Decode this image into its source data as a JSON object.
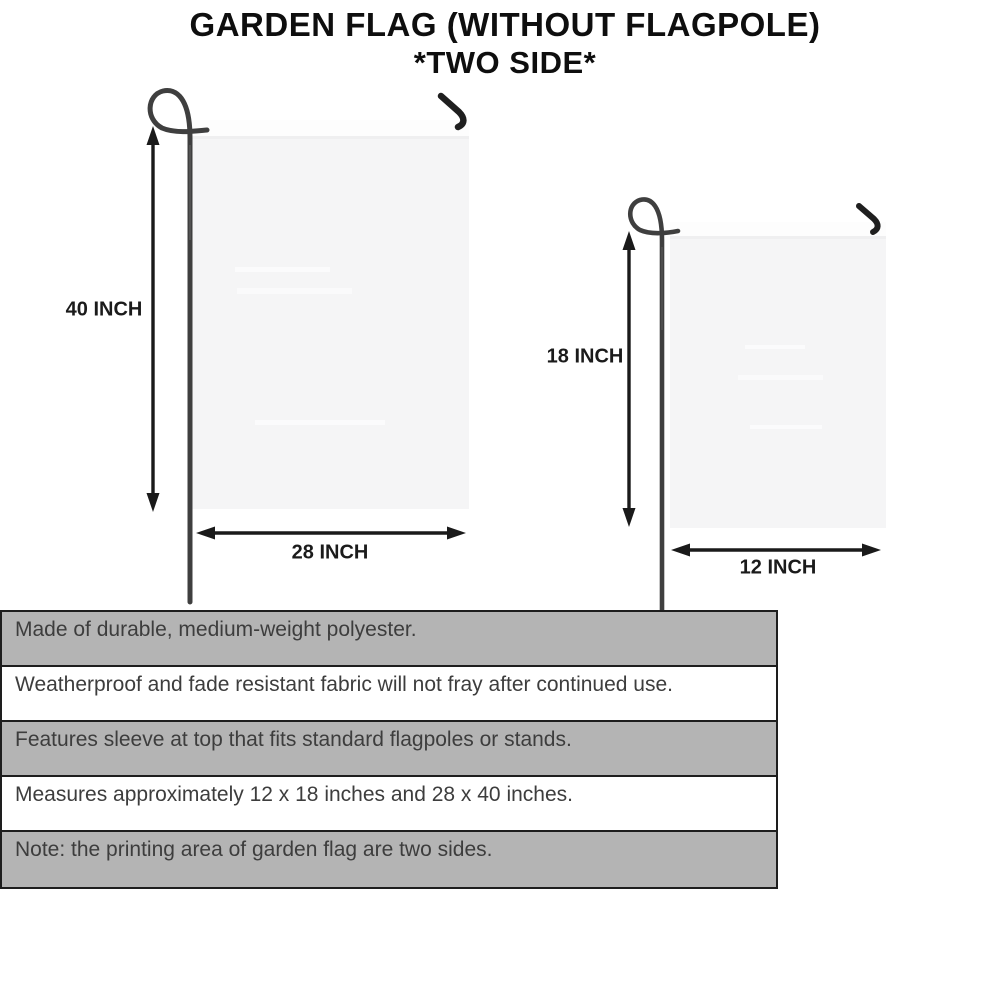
{
  "title": {
    "line1": "GARDEN FLAG (WITHOUT FLAGPOLE)",
    "line2": "*TWO SIDE*"
  },
  "flags": {
    "large": {
      "name": "28 x 40 inch garden flag",
      "height_label": "40 INCH",
      "width_label": "28 INCH"
    },
    "small": {
      "name": "12 x 18 inch garden flag",
      "height_label": "18 INCH",
      "width_label": "12 INCH"
    }
  },
  "features": [
    {
      "text": "Made of durable, medium-weight polyester.",
      "shaded": true
    },
    {
      "text": "Weatherproof and fade resistant fabric will not fray after continued use.",
      "shaded": false
    },
    {
      "text": "Features sleeve at top that fits standard flagpoles or stands.",
      "shaded": true
    },
    {
      "text": "Measures approximately 12 x 18 inches and 28 x 40 inches.",
      "shaded": false
    },
    {
      "text": "Note: the printing area of garden flag are two sides.",
      "shaded": true
    }
  ],
  "colors": {
    "background": "#ffffff",
    "title_text": "#0e0e0e",
    "dimension_text": "#1b1b1b",
    "arrow": "#1a1a1a",
    "pole": "#3f3f3f",
    "hook": "#1f1f1f",
    "flag_fill": "#f5f5f6",
    "flag_sleeve": "#fdfdfd",
    "table_shaded_row": "#b4b4b4",
    "table_white_row": "#ffffff",
    "table_border": "#1e1e1e",
    "table_text": "#3d3d3d"
  }
}
